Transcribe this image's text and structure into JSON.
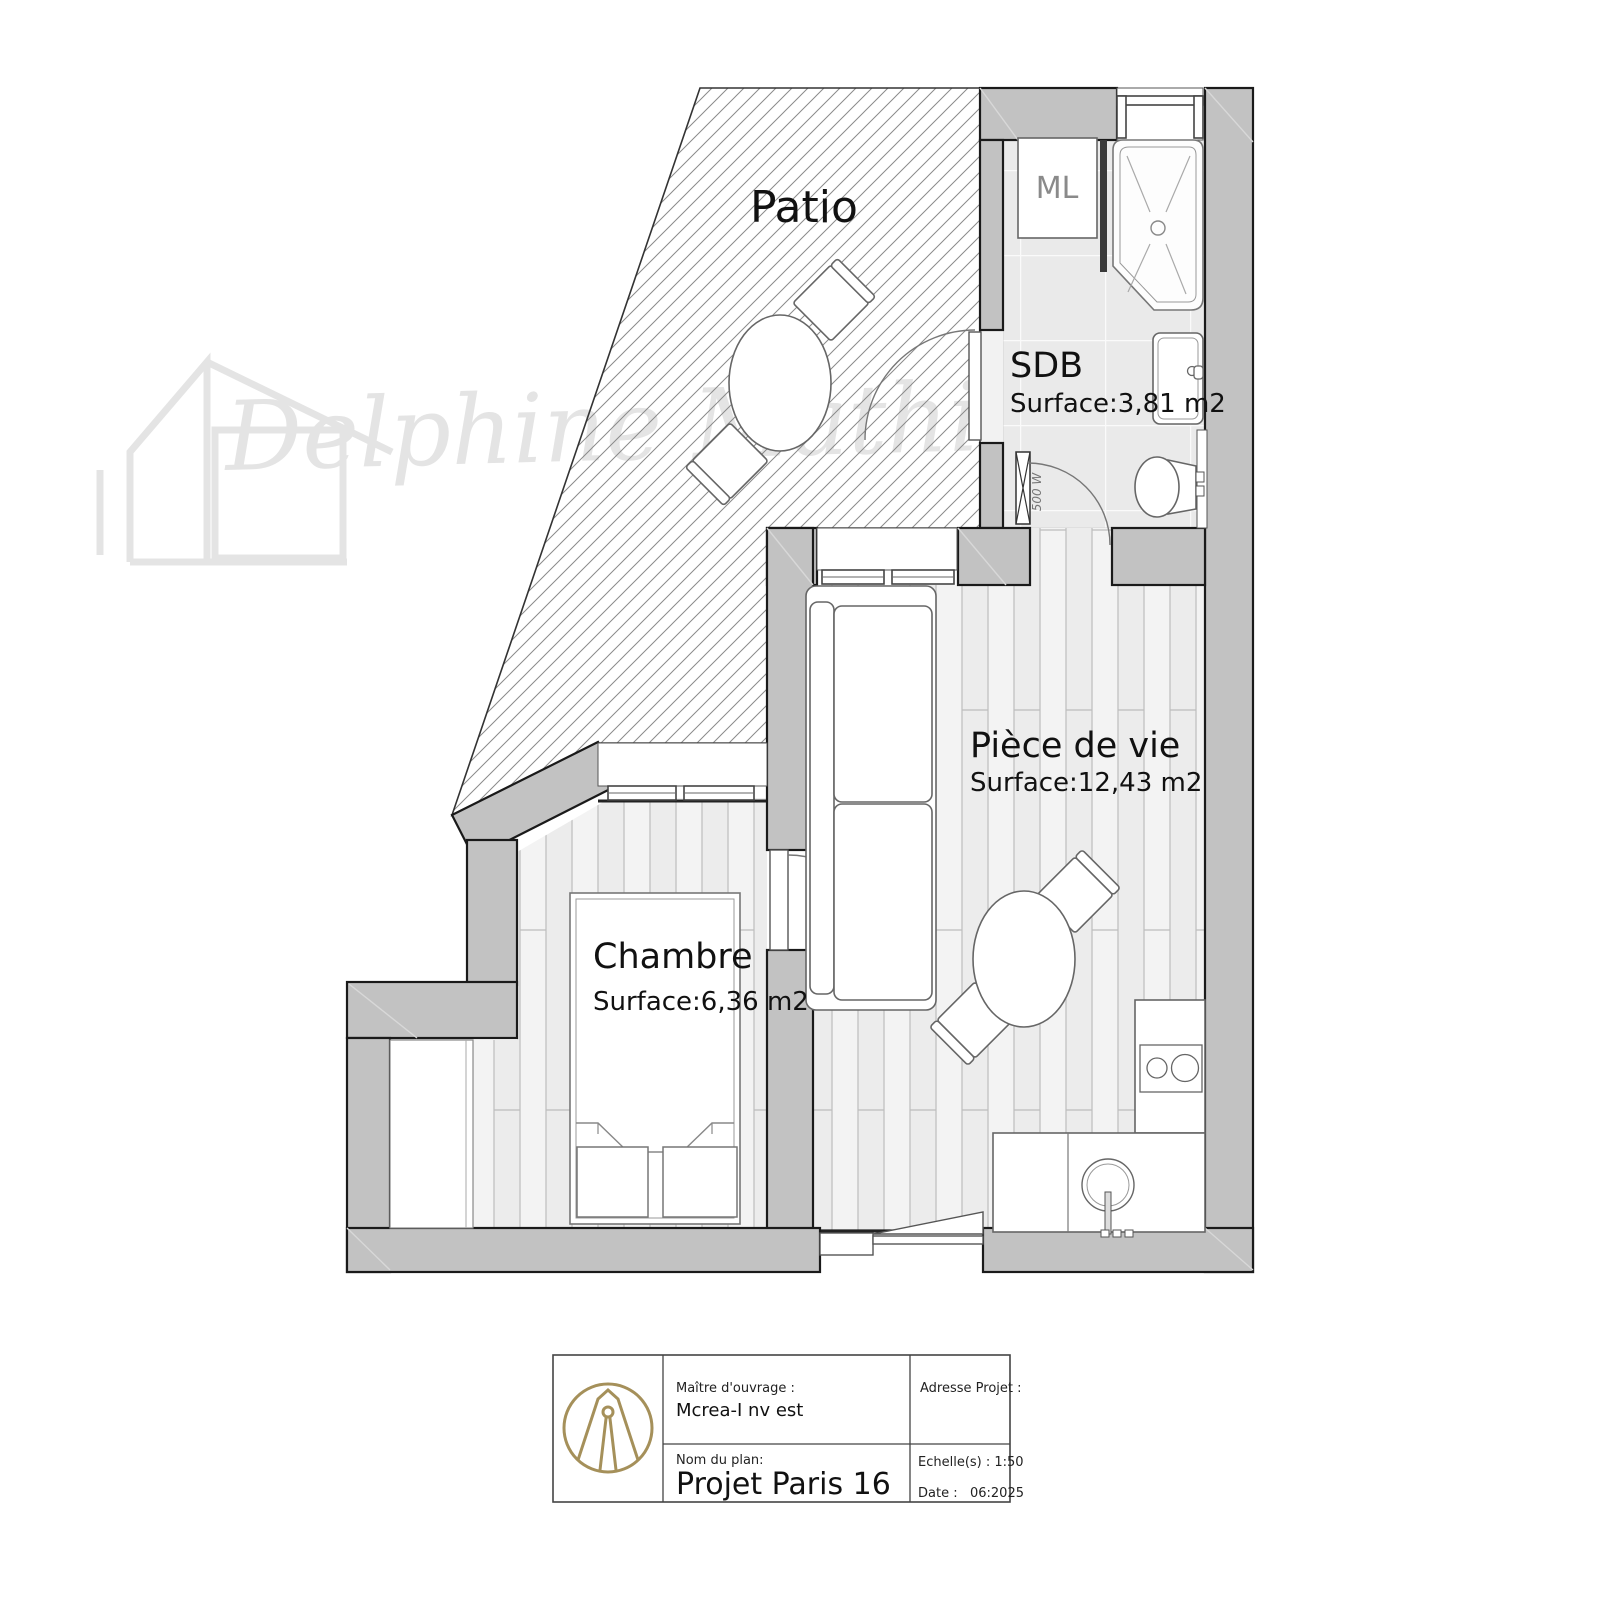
{
  "watermark": {
    "text": "Delphine Mathieu"
  },
  "rooms": {
    "patio": {
      "name": "Patio"
    },
    "sdb": {
      "name": "SDB",
      "surface": "Surface:3,81 m2"
    },
    "piece_de_vie": {
      "name": "Pièce de vie",
      "surface": "Surface:12,43 m2"
    },
    "chambre": {
      "name": "Chambre",
      "surface": "Surface:6,36 m2"
    }
  },
  "annotations": {
    "washing_machine": "ML",
    "radiator_power": "500 W"
  },
  "title_block": {
    "client_label": "Maître d'ouvrage :",
    "client_value": "Mcrea-I nv est",
    "plan_name_label": "Nom du plan:",
    "plan_name_value": "Projet Paris 16",
    "address_label": "Adresse Projet :",
    "scale_label": "Echelle(s) : 1:50",
    "date_label": "Date :   06:2025"
  },
  "colors": {
    "wall_fill": "#c2c2c2",
    "plank_floor": "#f1f1f1",
    "tile_floor": "#eaeaea",
    "logo_gold": "#a5905a",
    "watermark_gray": "#e4e4e4",
    "outline": "#1a1a1a"
  }
}
